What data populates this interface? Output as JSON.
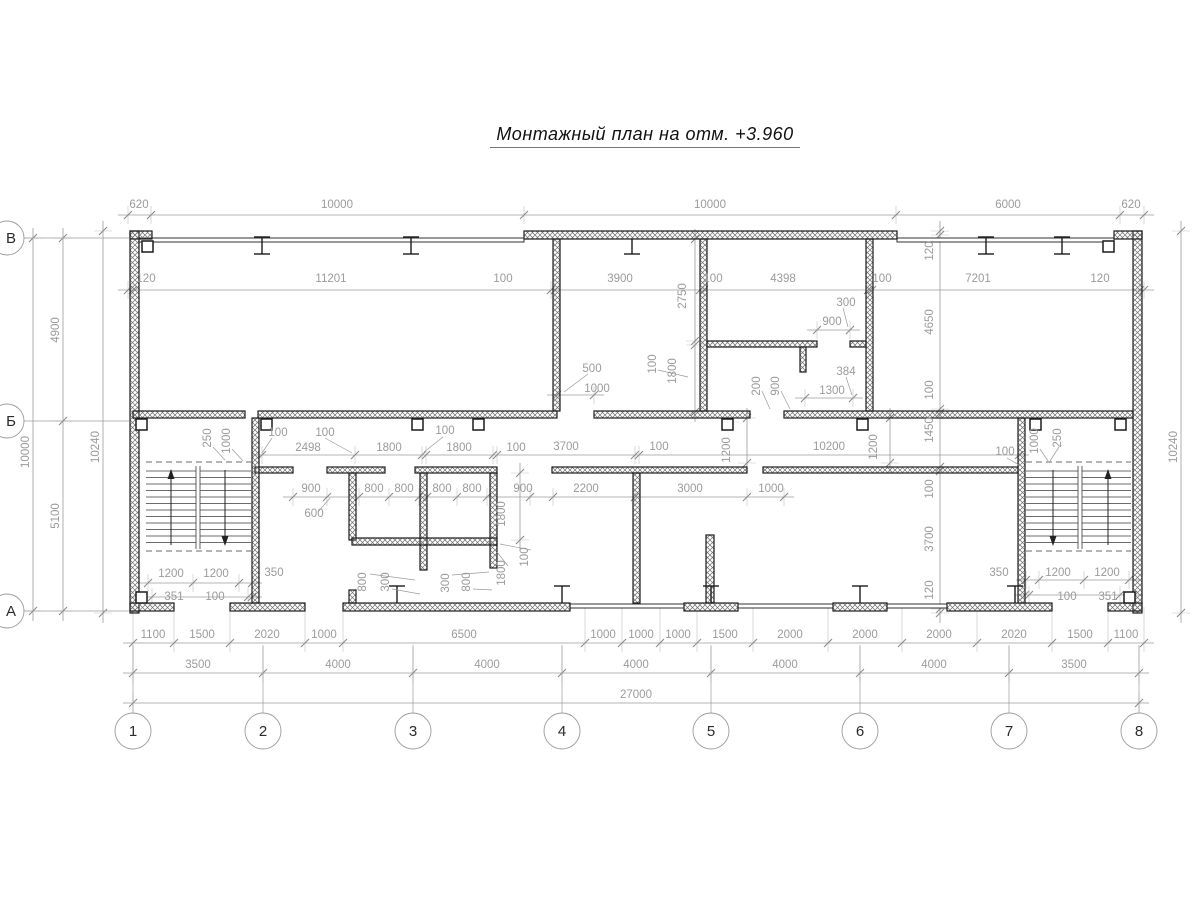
{
  "title": "Монтажный план на отм. +3.960",
  "colors": {
    "wall": "#1c1c1c",
    "hatch": "#6e6e6e",
    "dim": "#9b9b9b",
    "dim_text": "#9b9b9b",
    "axis_text": "#2b2b2b",
    "bg": "#ffffff"
  },
  "axes": {
    "cols": [
      {
        "n": "1",
        "x": 133
      },
      {
        "n": "2",
        "x": 263
      },
      {
        "n": "3",
        "x": 413
      },
      {
        "n": "4",
        "x": 562
      },
      {
        "n": "5",
        "x": 711
      },
      {
        "n": "6",
        "x": 860
      },
      {
        "n": "7",
        "x": 1009
      },
      {
        "n": "8",
        "x": 1139
      }
    ],
    "col_cy": 731,
    "rows": [
      {
        "n": "В",
        "y": 238
      },
      {
        "n": "Б",
        "y": 421
      },
      {
        "n": "А",
        "y": 611
      }
    ],
    "row_cx": 7
  },
  "plan": {
    "walls": [
      [
        130,
        231,
        9,
        382
      ],
      [
        1133,
        231,
        9,
        382
      ],
      [
        130,
        231,
        22,
        8
      ],
      [
        524,
        231,
        373,
        8
      ],
      [
        1114,
        231,
        28,
        8
      ],
      [
        130,
        603,
        44,
        8
      ],
      [
        230,
        603,
        75,
        8
      ],
      [
        343,
        603,
        227,
        8
      ],
      [
        684,
        603,
        54,
        8
      ],
      [
        833,
        603,
        54,
        8
      ],
      [
        947,
        603,
        105,
        8
      ],
      [
        1108,
        603,
        34,
        8
      ],
      [
        133,
        411,
        112,
        7
      ],
      [
        258,
        411,
        299,
        7
      ],
      [
        594,
        411,
        156,
        7
      ],
      [
        784,
        411,
        349,
        7
      ],
      [
        255,
        467,
        38,
        6
      ],
      [
        327,
        467,
        58,
        6
      ],
      [
        415,
        467,
        82,
        6
      ],
      [
        552,
        467,
        195,
        6
      ],
      [
        763,
        467,
        255,
        6
      ],
      [
        553,
        239,
        7,
        172
      ],
      [
        700,
        239,
        7,
        172
      ],
      [
        866,
        239,
        7,
        172
      ],
      [
        707,
        341,
        110,
        6
      ],
      [
        850,
        341,
        16,
        6
      ],
      [
        800,
        347,
        6,
        25
      ],
      [
        252,
        418,
        7,
        185
      ],
      [
        349,
        473,
        7,
        67
      ],
      [
        349,
        590,
        7,
        13
      ],
      [
        420,
        473,
        7,
        97
      ],
      [
        490,
        473,
        7,
        95
      ],
      [
        633,
        473,
        7,
        130
      ],
      [
        706,
        535,
        8,
        68
      ],
      [
        1018,
        418,
        7,
        185
      ],
      [
        352,
        538,
        145,
        7
      ]
    ],
    "thin_walls": [
      [
        139,
        238,
        385
      ],
      [
        897,
        238,
        217
      ],
      [
        570,
        604,
        114
      ],
      [
        738,
        604,
        95
      ],
      [
        887,
        604,
        60
      ]
    ],
    "squares": [
      [
        142,
        241
      ],
      [
        1103,
        241
      ],
      [
        136,
        419
      ],
      [
        261,
        419
      ],
      [
        412,
        419
      ],
      [
        473,
        419
      ],
      [
        722,
        419
      ],
      [
        857,
        419
      ],
      [
        1030,
        419
      ],
      [
        1115,
        419
      ],
      [
        136,
        592
      ],
      [
        1124,
        592
      ]
    ],
    "ibeams": [
      [
        262,
        237,
        17,
        1,
        1
      ],
      [
        411,
        237,
        17,
        1,
        1
      ],
      [
        986,
        237,
        17,
        1,
        1
      ],
      [
        1062,
        237,
        17,
        1,
        1
      ],
      [
        632,
        239,
        15,
        0,
        1
      ],
      [
        397,
        586,
        17,
        1,
        0
      ],
      [
        562,
        586,
        17,
        1,
        0
      ],
      [
        711,
        586,
        17,
        1,
        0
      ],
      [
        860,
        586,
        17,
        1,
        0
      ],
      [
        1015,
        586,
        17,
        1,
        0
      ]
    ],
    "stairs": [
      {
        "x1": 146,
        "x2": 251,
        "mid": 198,
        "ytop": 466,
        "ybot": 549,
        "dash": [
          462,
          551
        ],
        "arrows": [
          [
            171,
            "up"
          ],
          [
            225,
            "down"
          ]
        ]
      },
      {
        "x1": 1026,
        "x2": 1131,
        "mid": 1080,
        "ytop": 466,
        "ybot": 549,
        "dash": [
          462,
          551
        ],
        "arrows": [
          [
            1053,
            "down"
          ],
          [
            1108,
            "up"
          ]
        ]
      }
    ],
    "hchains": [
      {
        "y": 215,
        "t": [
          128,
          151,
          524,
          896,
          1120,
          1144
        ]
      },
      {
        "y": 290,
        "t": [
          128,
          133,
          551,
          555,
          700,
          704,
          868,
          872,
          1140,
          1144
        ]
      },
      {
        "y": 455,
        "t": [
          262,
          355,
          422,
          426,
          493,
          497,
          635,
          639,
          1019
        ]
      },
      {
        "y": 497,
        "t": [
          293,
          327,
          359,
          389,
          419,
          427,
          457,
          487,
          530,
          553,
          635,
          747,
          784
        ]
      },
      {
        "y": 330,
        "t": [
          817,
          850
        ]
      },
      {
        "y": 398,
        "t": [
          805,
          853
        ]
      },
      {
        "y": 395,
        "t": [
          557,
          594
        ]
      },
      {
        "y": 583,
        "t": [
          148,
          193,
          239,
          252
        ]
      },
      {
        "y": 597,
        "t": [
          139,
          152,
          248,
          252
        ]
      },
      {
        "y": 580,
        "t": [
          1026,
          1039,
          1084,
          1129
        ]
      },
      {
        "y": 595,
        "t": [
          1025,
          1029,
          1120,
          1133
        ]
      },
      {
        "y": 643,
        "t": [
          133,
          174,
          230,
          305,
          343,
          585,
          622,
          660,
          697,
          753,
          828,
          902,
          977,
          1052,
          1108,
          1144
        ],
        "up": 36
      },
      {
        "y": 673,
        "t": [
          133,
          263,
          413,
          562,
          711,
          860,
          1009,
          1139
        ],
        "up": 26
      },
      {
        "y": 703,
        "t": [
          133,
          1139
        ]
      }
    ],
    "vchains": [
      {
        "x": 33,
        "t": [
          238,
          611
        ]
      },
      {
        "x": 63,
        "t": [
          238,
          421,
          611
        ]
      },
      {
        "x": 103,
        "t": [
          231,
          613
        ]
      },
      {
        "x": 1181,
        "t": [
          231,
          613
        ]
      },
      {
        "x": 940,
        "t": [
          231,
          235,
          409,
          413,
          467,
          471,
          609,
          613
        ]
      },
      {
        "x": 695,
        "t": [
          239,
          341,
          345,
          412
        ]
      },
      {
        "x": 747,
        "t": [
          418,
          463
        ]
      },
      {
        "x": 890,
        "t": [
          418,
          463
        ]
      },
      {
        "x": 520,
        "t": [
          473,
          540
        ]
      }
    ],
    "leaders": [
      [
        272,
        438,
        262,
        453
      ],
      [
        325,
        438,
        352,
        453
      ],
      [
        443,
        437,
        424,
        452
      ],
      [
        588,
        374,
        564,
        392
      ],
      [
        843,
        308,
        848,
        327
      ],
      [
        846,
        377,
        852,
        395
      ],
      [
        318,
        512,
        330,
        498
      ],
      [
        762,
        391,
        770,
        409
      ],
      [
        781,
        391,
        790,
        409
      ],
      [
        213,
        447,
        225,
        460
      ],
      [
        232,
        449,
        243,
        461
      ],
      [
        1040,
        449,
        1048,
        461
      ],
      [
        1059,
        447,
        1050,
        461
      ],
      [
        370,
        574,
        415,
        580
      ],
      [
        392,
        589,
        420,
        594
      ],
      [
        452,
        575,
        489,
        572
      ],
      [
        473,
        589,
        492,
        590
      ],
      [
        508,
        566,
        497,
        552
      ],
      [
        531,
        550,
        500,
        544
      ],
      [
        1007,
        458,
        1019,
        465
      ],
      [
        658,
        370,
        688,
        377
      ]
    ],
    "labels": [
      [
        139,
        208,
        "620",
        0
      ],
      [
        337,
        208,
        "10000",
        0
      ],
      [
        710,
        208,
        "10000",
        0
      ],
      [
        1008,
        208,
        "6000",
        0
      ],
      [
        1131,
        208,
        "620",
        0
      ],
      [
        146,
        282,
        "120",
        0
      ],
      [
        331,
        282,
        "11201",
        0
      ],
      [
        503,
        282,
        "100",
        0
      ],
      [
        620,
        282,
        "3900",
        0
      ],
      [
        713,
        282,
        "100",
        0
      ],
      [
        783,
        282,
        "4398",
        0
      ],
      [
        882,
        282,
        "100",
        0
      ],
      [
        978,
        282,
        "7201",
        0
      ],
      [
        1100,
        282,
        "120",
        0
      ],
      [
        308,
        451,
        "2498",
        0
      ],
      [
        389,
        451,
        "1800",
        0
      ],
      [
        459,
        451,
        "1800",
        0
      ],
      [
        566,
        450,
        "3700",
        0
      ],
      [
        829,
        450,
        "10200",
        0
      ],
      [
        278,
        436,
        "100",
        0
      ],
      [
        325,
        436,
        "100",
        0
      ],
      [
        445,
        434,
        "100",
        0
      ],
      [
        516,
        451,
        "100",
        0
      ],
      [
        659,
        450,
        "100",
        0
      ],
      [
        1005,
        455,
        "100",
        0
      ],
      [
        846,
        306,
        "300",
        0
      ],
      [
        832,
        325,
        "900",
        0
      ],
      [
        846,
        375,
        "384",
        0
      ],
      [
        832,
        394,
        "1300",
        0
      ],
      [
        592,
        372,
        "500",
        0
      ],
      [
        597,
        392,
        "1000",
        0
      ],
      [
        311,
        492,
        "900",
        0
      ],
      [
        374,
        492,
        "800",
        0
      ],
      [
        404,
        492,
        "800",
        0
      ],
      [
        442,
        492,
        "800",
        0
      ],
      [
        472,
        492,
        "800",
        0
      ],
      [
        523,
        492,
        "900",
        0
      ],
      [
        586,
        492,
        "2200",
        0
      ],
      [
        690,
        492,
        "3000",
        0
      ],
      [
        771,
        492,
        "1000",
        0
      ],
      [
        314,
        517,
        "600",
        0
      ],
      [
        171,
        577,
        "1200",
        0
      ],
      [
        216,
        577,
        "1200",
        0
      ],
      [
        274,
        576,
        "350",
        0
      ],
      [
        174,
        600,
        "351",
        0
      ],
      [
        215,
        600,
        "100",
        0
      ],
      [
        999,
        576,
        "350",
        0
      ],
      [
        1058,
        576,
        "1200",
        0
      ],
      [
        1107,
        576,
        "1200",
        0
      ],
      [
        1067,
        600,
        "100",
        0
      ],
      [
        1108,
        600,
        "351",
        0
      ],
      [
        153,
        638,
        "1100",
        0
      ],
      [
        202,
        638,
        "1500",
        0
      ],
      [
        267,
        638,
        "2020",
        0
      ],
      [
        324,
        638,
        "1000",
        0
      ],
      [
        464,
        638,
        "6500",
        0
      ],
      [
        603,
        638,
        "1000",
        0
      ],
      [
        641,
        638,
        "1000",
        0
      ],
      [
        678,
        638,
        "1000",
        0
      ],
      [
        725,
        638,
        "1500",
        0
      ],
      [
        790,
        638,
        "2000",
        0
      ],
      [
        865,
        638,
        "2000",
        0
      ],
      [
        939,
        638,
        "2000",
        0
      ],
      [
        1014,
        638,
        "2020",
        0
      ],
      [
        1080,
        638,
        "1500",
        0
      ],
      [
        1126,
        638,
        "1100",
        0
      ],
      [
        198,
        668,
        "3500",
        0
      ],
      [
        338,
        668,
        "4000",
        0
      ],
      [
        487,
        668,
        "4000",
        0
      ],
      [
        636,
        668,
        "4000",
        0
      ],
      [
        785,
        668,
        "4000",
        0
      ],
      [
        934,
        668,
        "4000",
        0
      ],
      [
        1074,
        668,
        "3500",
        0
      ],
      [
        636,
        698,
        "27000",
        0
      ],
      [
        59,
        330,
        "4900",
        1
      ],
      [
        59,
        516,
        "5100",
        1
      ],
      [
        29,
        452,
        "10000",
        1
      ],
      [
        99,
        447,
        "10240",
        1
      ],
      [
        1177,
        447,
        "10240",
        1
      ],
      [
        933,
        251,
        "120",
        1
      ],
      [
        933,
        322,
        "4650",
        1
      ],
      [
        933,
        390,
        "100",
        1
      ],
      [
        933,
        430,
        "1450",
        1
      ],
      [
        933,
        489,
        "100",
        1
      ],
      [
        933,
        539,
        "3700",
        1
      ],
      [
        933,
        590,
        "120",
        1
      ],
      [
        686,
        296,
        "2750",
        1
      ],
      [
        656,
        364,
        "100",
        1
      ],
      [
        676,
        371,
        "1800",
        1
      ],
      [
        760,
        386,
        "200",
        1
      ],
      [
        779,
        386,
        "900",
        1
      ],
      [
        211,
        438,
        "250",
        1
      ],
      [
        230,
        441,
        "1000",
        1
      ],
      [
        1038,
        441,
        "1000",
        1
      ],
      [
        1061,
        438,
        "250",
        1
      ],
      [
        730,
        450,
        "1200",
        1
      ],
      [
        877,
        447,
        "1200",
        1
      ],
      [
        505,
        514,
        "1800",
        1
      ],
      [
        505,
        573,
        "1800",
        1
      ],
      [
        528,
        557,
        "100",
        1
      ],
      [
        366,
        582,
        "800",
        1
      ],
      [
        389,
        582,
        "300",
        1
      ],
      [
        449,
        583,
        "300",
        1
      ],
      [
        470,
        582,
        "800",
        1
      ]
    ]
  }
}
